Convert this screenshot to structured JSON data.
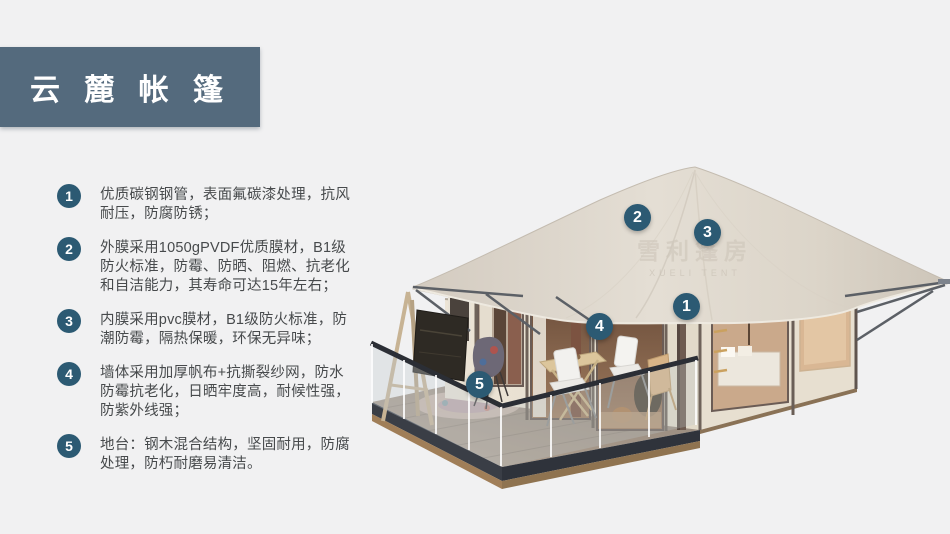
{
  "header": {
    "title": "云 麓 帐 篷"
  },
  "features": [
    {
      "num": "1",
      "text": "优质碳钢钢管，表面氟碳漆处理，抗风耐压，防腐防锈；"
    },
    {
      "num": "2",
      "text": "外膜采用1050gPVDF优质膜材，B1级防火标准，防霉、防晒、阻燃、抗老化和自洁能力，其寿命可达15年左右；"
    },
    {
      "num": "3",
      "text": "内膜采用pvc膜材，B1级防火标准，防潮防霉，隔热保暖，环保无异味；"
    },
    {
      "num": "4",
      "text": "墙体采用加厚帆布+抗撕裂纱网，防水防霉抗老化，日晒牢度高，耐候性强，防紫外线强；"
    },
    {
      "num": "5",
      "text": "地台：钢木混合结构，坚固耐用，防腐处理，防朽耐磨易清洁。"
    }
  ],
  "callouts": [
    {
      "num": "1"
    },
    {
      "num": "2"
    },
    {
      "num": "3"
    },
    {
      "num": "4"
    },
    {
      "num": "5"
    }
  ],
  "watermark": {
    "cn": "雪利篷房",
    "en": "XUELI TENT"
  },
  "colors": {
    "banner": "#546a7d",
    "badge": "#2c5a73",
    "body_text": "#474a4c",
    "background": "#f1f1f2",
    "roof": "#ddd6cb",
    "wall": "#e9e1d2",
    "deck_fascia": "#363b44",
    "deck_wood_base": "#9a7a58"
  }
}
